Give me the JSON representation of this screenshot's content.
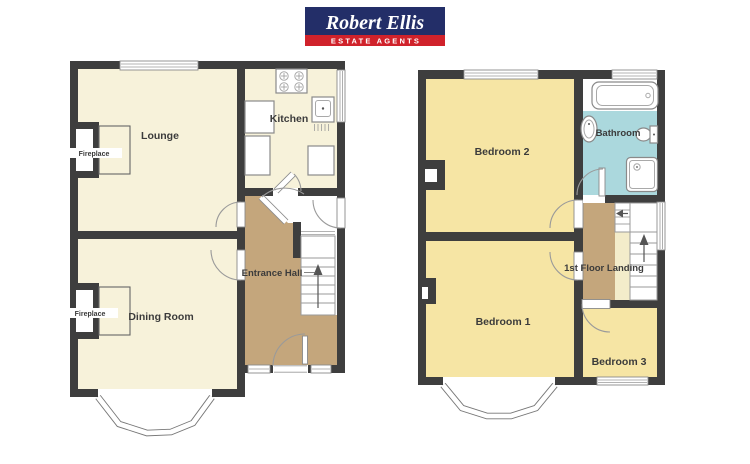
{
  "brand": {
    "name": "Robert Ellis",
    "tagline": "ESTATE AGENTS"
  },
  "floors": {
    "ground": {
      "lounge": "Lounge",
      "kitchen": "Kitchen",
      "dining_room": "Dining Room",
      "entrance_hall": "Entrance Hall",
      "fireplace": "Fireplace"
    },
    "first": {
      "bedroom1": "Bedroom 1",
      "bedroom2": "Bedroom 2",
      "bedroom3": "Bedroom 3",
      "bathroom": "Bathroom",
      "landing": "1st Floor Landing"
    }
  },
  "colors": {
    "wall": "#3e3e3e",
    "ground_room": "#f7f2da",
    "bedroom": "#f6e5a4",
    "hall": "#c4a67c",
    "bathroom": "#abd8dd",
    "landing_strip": "#f3ecca",
    "brand_navy": "#232e68",
    "brand_red": "#d0222b"
  }
}
